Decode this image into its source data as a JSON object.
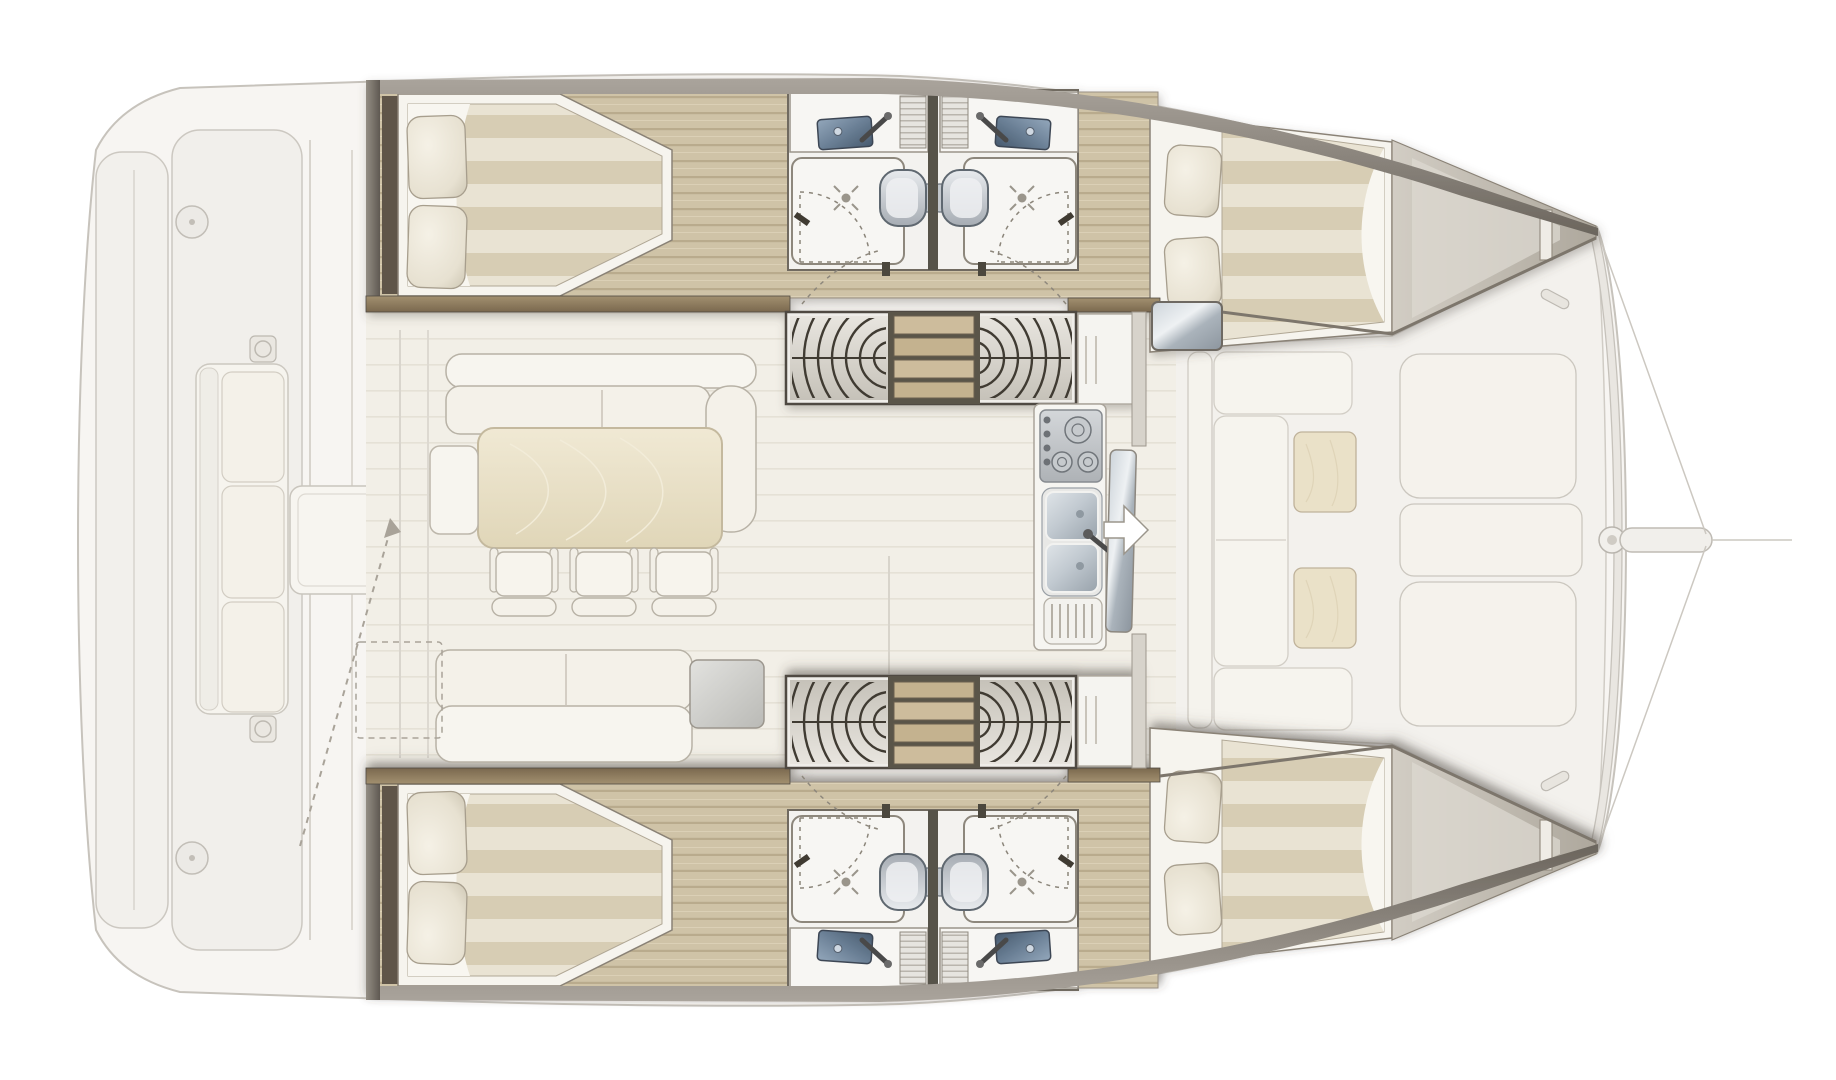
{
  "meta": {
    "type": "floor-plan",
    "subject": "sailing-catamaran-interior-layout",
    "orientation": "bow-right-stern-left",
    "style": "rendered architectural plan, exterior decks faded, interior accommodations highlighted"
  },
  "layout": {
    "port_hull_top": {
      "areas": [
        "aft-cabin-double-berth",
        "aft-head-shower-sink-toilet",
        "forward-head-shower-sink-toilet",
        "forward-cabin-double-berth",
        "companionway-stairs-curved",
        "hull-corridor-wood-floor",
        "bow-storage-locker"
      ]
    },
    "starboard_hull_bottom": {
      "areas": [
        "aft-cabin-double-berth",
        "aft-head-shower-sink-toilet",
        "forward-head-shower-sink-toilet",
        "forward-cabin-double-berth",
        "companionway-stairs-curved",
        "hull-corridor-wood-floor",
        "bow-storage-locker"
      ]
    },
    "saloon": {
      "items": [
        "l-shaped-settee",
        "dining-table",
        "three-dining-chairs",
        "side-bench",
        "aft-facing-sofa",
        "glossy-sideboard-panel",
        "galley-counter-with-shelves",
        "three-burner-stove",
        "double-galley-sink-with-drainer",
        "forward-sliding-glass-door",
        "white-entry-arrow",
        "dashed-sliding-door-outline",
        "dashed-passage-arrow"
      ]
    },
    "aft_cockpit_faded": {
      "items": [
        "transom-steps",
        "deck-hatch-round-x2",
        "bench-sofa-three-cushions",
        "winch-pad-x2",
        "cockpit-table"
      ]
    },
    "foredeck_faded": {
      "items": [
        "u-shaped-seating",
        "teak-table-x2",
        "sunpad-x3",
        "forward-crossbeam",
        "center-fitting",
        "bowsprit",
        "forestay-bridle-lines",
        "cleat-x2"
      ]
    }
  },
  "palette": {
    "paper": "#ffffff",
    "ext-fill": "#f5f3f0",
    "ext-fill2": "#efede9",
    "ext-line": "#c7c3bc",
    "ext-furn": "#f6f4ee",
    "ext-furn-line": "#cfcbc2",
    "wall-dark": "#5e5850",
    "wall-mid": "#8e887e",
    "wood-wall-a": "#a29070",
    "wood-wall-b": "#7a684e",
    "wood-floor": "#cfc3a7",
    "wood-floor-line": "#b9ab8d",
    "wood-floor-hi": "#dbd0b6",
    "duvet-a": "#e9e3d3",
    "duvet-b": "#d7cdb4",
    "linen": "#f8f6f0",
    "pillow-line": "#a79e8d",
    "white-fix": "#f7f6f3",
    "fix-line": "#8d877c",
    "basin-a": "#93a7bb",
    "basin-b": "#475a6e",
    "toilet-a": "#e8ebee",
    "toilet-b": "#a6acb3",
    "steel-a": "#dfe4e8",
    "steel-b": "#98a2ab",
    "glass-a": "#cdd4da",
    "glass-b": "#8c959e",
    "arc-ink": "#3f3a33",
    "step-wood": "#cdbc9c",
    "step-dark": "#6b614f",
    "saloon-floor": "#f2efe7",
    "saloon-line": "#e5e1d6",
    "sofa": "#f5f2ea",
    "sofa-line": "#b8b2a6",
    "table-a": "#f0e9d4",
    "table-b": "#e0d6b8",
    "dash": "#a9a399",
    "wedge-a": "#d2cdc4",
    "wedge-b": "#aea89d",
    "stove-a": "#d4d7da",
    "stove-b": "#aeb2b6"
  }
}
